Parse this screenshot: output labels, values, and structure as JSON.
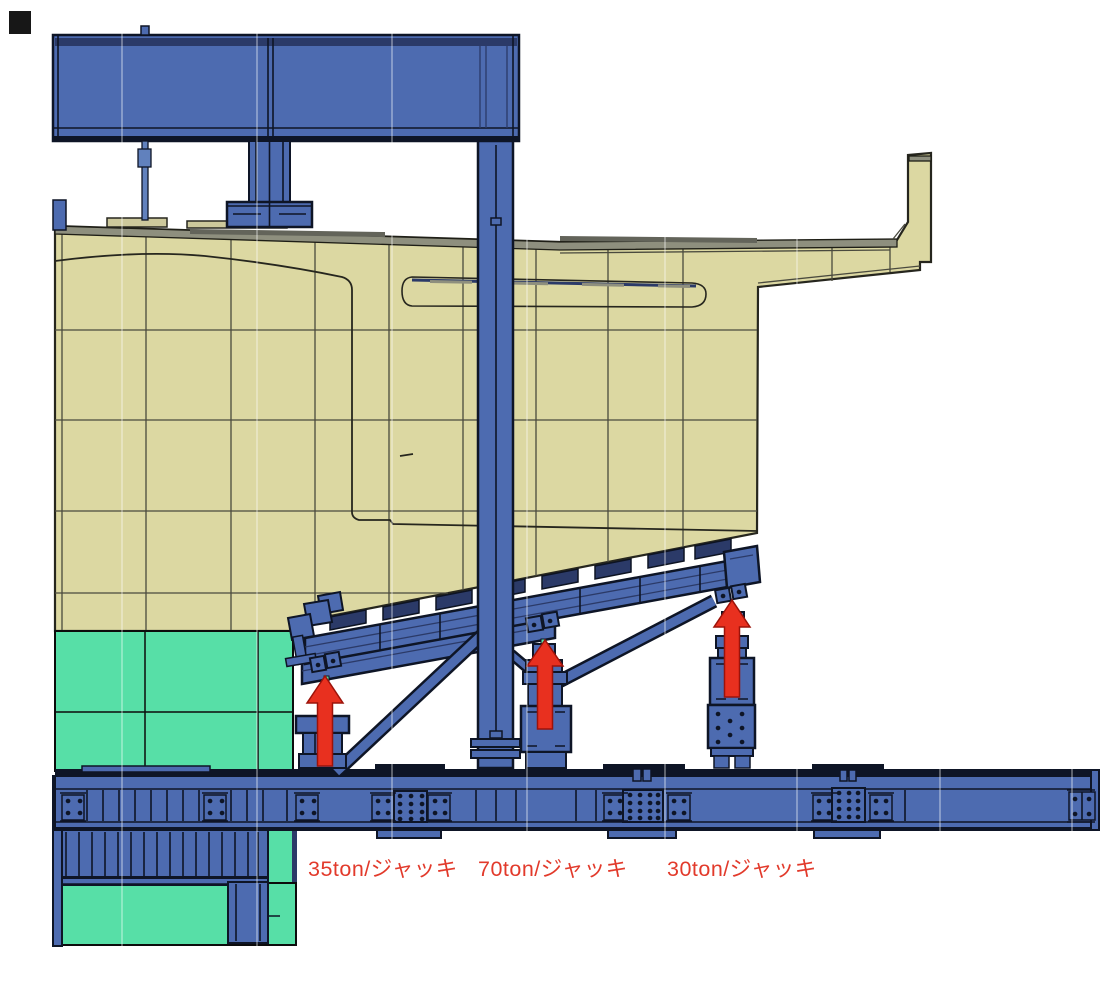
{
  "drawing": {
    "kind": "CAD side-view jacking arrangement of hull block on support cradle",
    "jacks": [
      {
        "id": "jack-35t",
        "capacity": "35ton",
        "label": "35ton/ジャッキ",
        "arrow_direction": "up"
      },
      {
        "id": "jack-70t",
        "capacity": "70ton",
        "label": "70ton/ジャッキ",
        "arrow_direction": "up"
      },
      {
        "id": "jack-30t",
        "capacity": "30ton",
        "label": "30ton/ジャッキ",
        "arrow_direction": "up"
      }
    ]
  },
  "colors": {
    "background": "#ffffff",
    "steel_blue": "#4d6bb0",
    "steel_dark": "#0e1526",
    "navy_stripe": "#2b3a68",
    "hull_tan": "#dcd8a2",
    "hull_line": "#4a4a3e",
    "deck_gray": "#8e8f7e",
    "deck_dark": "#63645a",
    "block_green": "#57dfa7",
    "arrow_red": "#e8301f",
    "label_red": "#e23a2b",
    "rod_blue": "#6181bd",
    "pad_tan": "#cdc99c"
  }
}
